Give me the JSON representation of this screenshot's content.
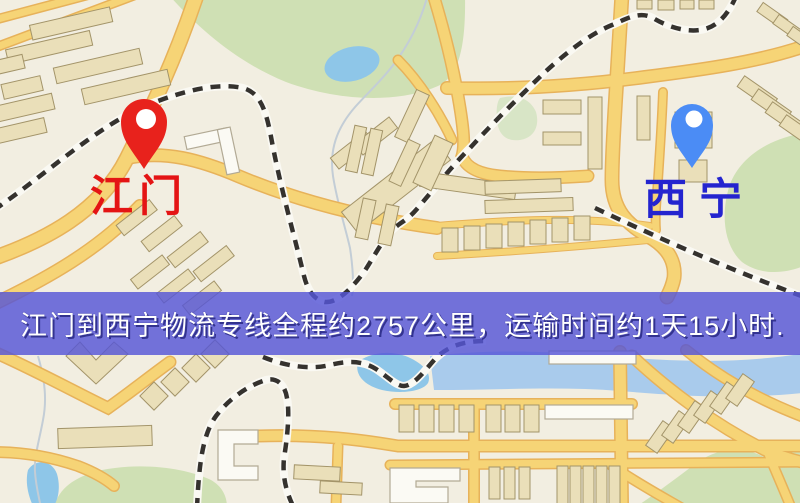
{
  "page": {
    "width": 800,
    "height": 503,
    "kind": "logistics route map image"
  },
  "map": {
    "background_color": "#f2eee1",
    "palette": {
      "road_fill": "#f6d476",
      "road_casing": "#e7b25a",
      "building": "#eadfb9",
      "park": "#cfe0b4",
      "water": "#8ec6e8",
      "railway": "#35322e"
    },
    "origin": {
      "name": "江门",
      "pin_color": "#e8221c",
      "label_color": "#e41414"
    },
    "destination": {
      "name": "西宁",
      "pin_color": "#4b8cf5",
      "label_color": "#2424cf"
    }
  },
  "banner": {
    "text": "江门到西宁物流专线全程约2757公里，运输时间约1天15小时.",
    "background_color": "#5656d7",
    "text_color": "#ffffff",
    "route": {
      "from": "江门",
      "to": "西宁",
      "distance": "约2757公里",
      "duration": "约1天15小时"
    }
  }
}
